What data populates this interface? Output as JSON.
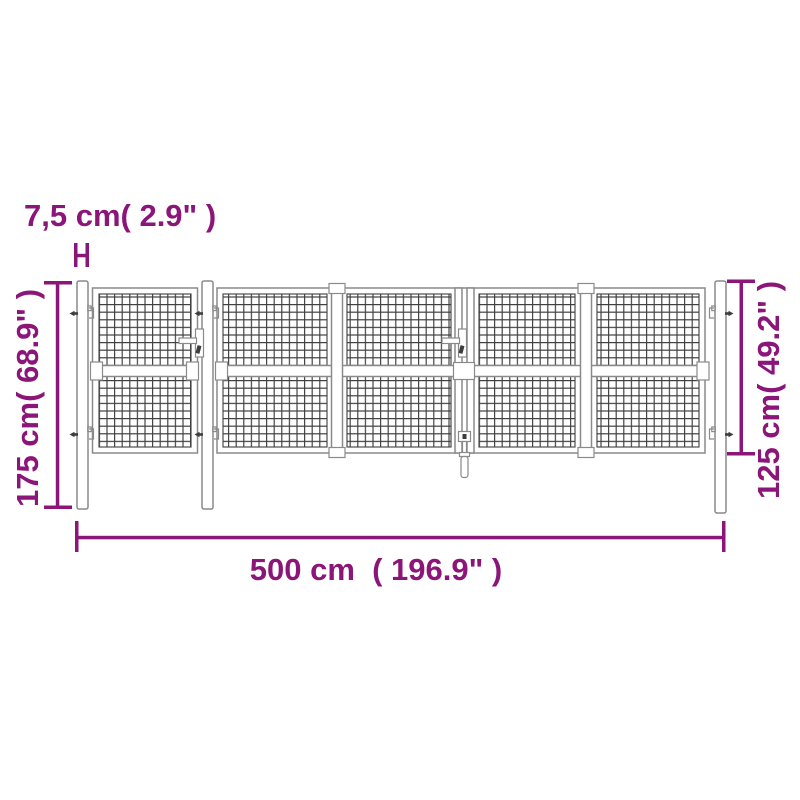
{
  "colors": {
    "dimension_annotation": "#8b1578",
    "structure_outline": "#8a8a8a",
    "mesh_wire": "#3d3d3d",
    "background": "#ffffff"
  },
  "dimensions": {
    "post_width": "7,5 cm( 2.9\" )",
    "post_height": "175 cm( 68.9\" )",
    "gate_height": "125 cm( 49.2\" )",
    "total_width": "500 cm  ( 196.9\" )"
  }
}
